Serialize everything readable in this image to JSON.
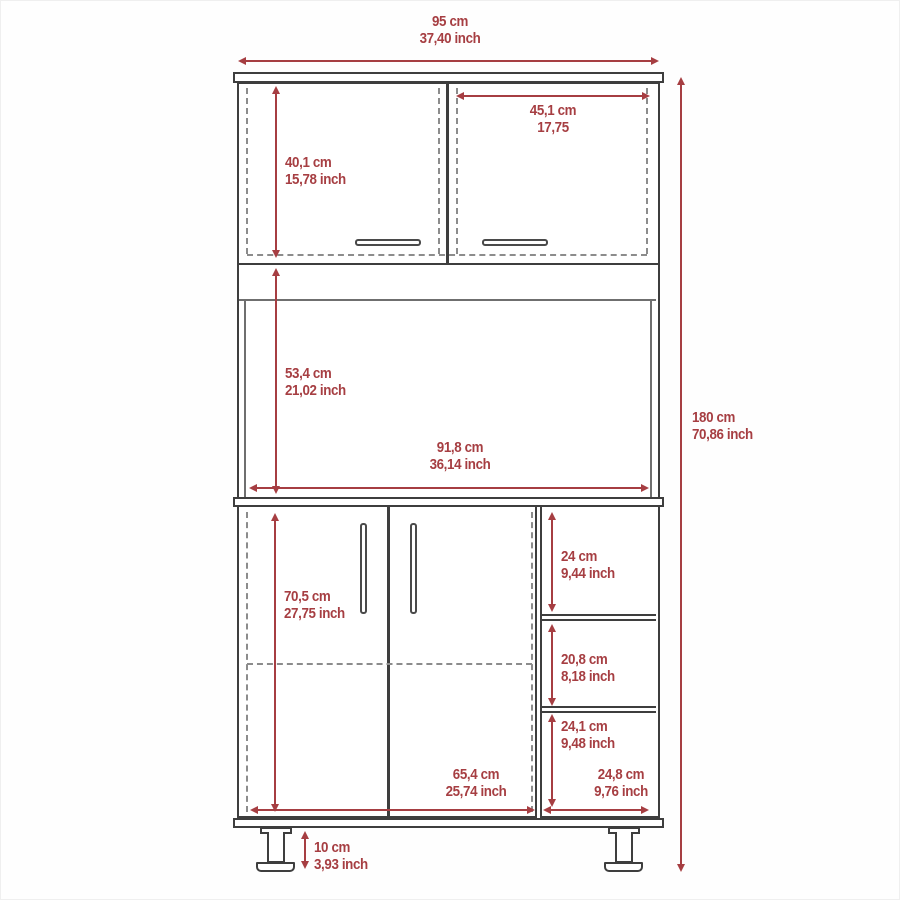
{
  "diagram_type": "furniture-dimension-drawing",
  "colors": {
    "dimension_red": "#a63e42",
    "outline_ink": "#3e3e3e",
    "dashed_gray": "#8c8c8c"
  },
  "dimensions": {
    "overall_width": {
      "cm": "95 cm",
      "inch": "37,40 inch"
    },
    "overall_height": {
      "cm": "180 cm",
      "inch": "70,86 inch"
    },
    "upper_left_door_height": {
      "cm": "40,1 cm",
      "inch": "15,78 inch"
    },
    "upper_right_door_width": {
      "cm": "45,1 cm",
      "inch": "17,75"
    },
    "open_shelf_height": {
      "cm": "53,4 cm",
      "inch": "21,02 inch"
    },
    "open_shelf_width": {
      "cm": "91,8 cm",
      "inch": "36,14 inch"
    },
    "lower_door_height": {
      "cm": "70,5 cm",
      "inch": "27,75 inch"
    },
    "lower_door_width": {
      "cm": "65,4 cm",
      "inch": "25,74 inch"
    },
    "side_shelf_top_height": {
      "cm": "24 cm",
      "inch": "9,44 inch"
    },
    "side_shelf_middle_height": {
      "cm": "20,8 cm",
      "inch": "8,18 inch"
    },
    "side_shelf_bottom_height": {
      "cm": "24,1 cm",
      "inch": "9,48 inch"
    },
    "side_shelf_width": {
      "cm": "24,8 cm",
      "inch": "9,76 inch"
    },
    "leg_height": {
      "cm": "10 cm",
      "inch": "3,93 inch"
    }
  }
}
